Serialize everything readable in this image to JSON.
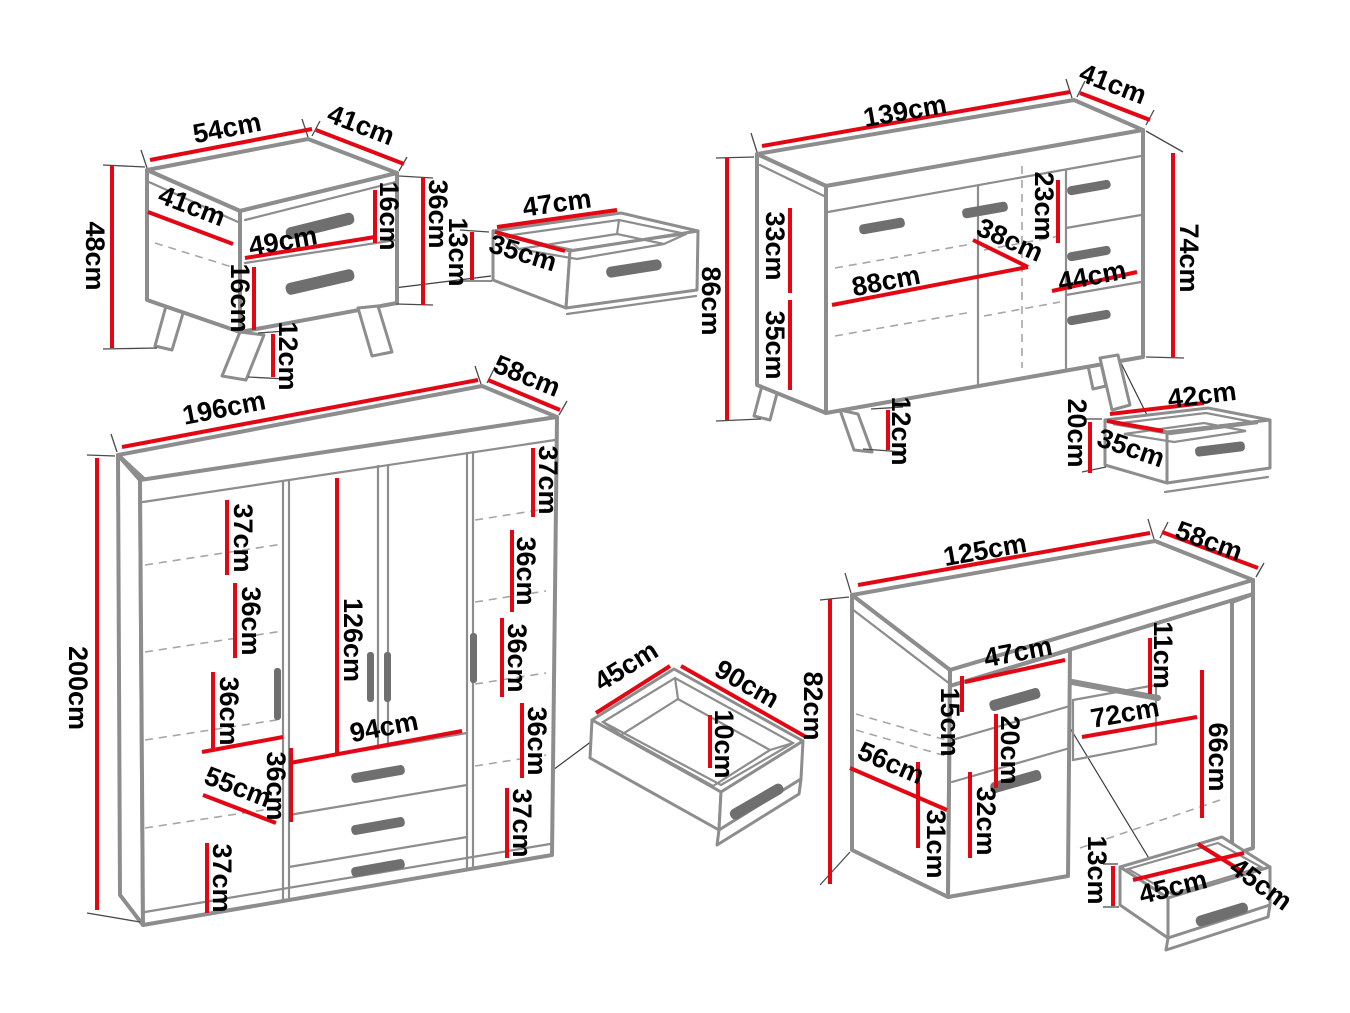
{
  "title": "Bedroom furniture set dimension diagram",
  "unit": "cm",
  "colors": {
    "dimension_line": "#e30613",
    "furniture_outline": "#8d8d8d",
    "label_text": "#000000",
    "handle": "#6f6f6f",
    "background": "#ffffff"
  },
  "furniture": {
    "nightstand": {
      "label": "nightstand",
      "dims": {
        "top_width": "54cm",
        "top_depth": "41cm",
        "height": "48cm",
        "inner_depth": "41cm",
        "drawer_width": "49cm",
        "upper_drawer_height": "16cm",
        "lower_drawer_height": "16cm",
        "carcass_height": "36cm",
        "leg_height": "12cm"
      }
    },
    "nightstand_drawer": {
      "label": "nightstand drawer",
      "dims": {
        "width": "47cm",
        "depth": "35cm",
        "height": "13cm"
      }
    },
    "sideboard": {
      "label": "sideboard",
      "dims": {
        "top_width": "139cm",
        "top_depth": "41cm",
        "height": "86cm",
        "upper_shelf_height": "33cm",
        "lower_shelf_height": "35cm",
        "inner_width": "88cm",
        "door_width": "38cm",
        "drawer_height": "23cm",
        "drawer_width": "44cm",
        "side_height": "74cm",
        "leg_height": "12cm"
      }
    },
    "sideboard_drawer": {
      "label": "sideboard drawer",
      "dims": {
        "width": "42cm",
        "depth": "35cm",
        "height": "20cm"
      }
    },
    "wardrobe": {
      "label": "wardrobe",
      "dims": {
        "top_width": "196cm",
        "top_depth": "58cm",
        "height": "200cm",
        "left_shelf_1": "37cm",
        "left_shelf_2": "36cm",
        "left_shelf_3": "36cm",
        "left_depth": "55cm",
        "left_shelf_4": "37cm",
        "door_height": "126cm",
        "drawer_width": "94cm",
        "center_shelf": "36cm",
        "right_shelf_1": "37cm",
        "right_shelf_2": "36cm",
        "right_shelf_3": "36cm",
        "right_shelf_4": "36cm",
        "right_shelf_5": "37cm"
      }
    },
    "wardrobe_drawer": {
      "label": "wardrobe drawer",
      "dims": {
        "depth": "45cm",
        "width": "90cm",
        "height": "10cm"
      }
    },
    "desk": {
      "label": "desk",
      "dims": {
        "top_width": "125cm",
        "top_depth": "58cm",
        "height": "82cm",
        "drawer_width": "47cm",
        "drawer_height": "15cm",
        "shelf_height": "20cm",
        "tray_height": "11cm",
        "niche_width": "72cm",
        "niche_height": "66cm",
        "side_depth": "56cm",
        "bottom_height": "31cm",
        "door_height": "32cm"
      }
    },
    "desk_drawer": {
      "label": "desk drawer",
      "dims": {
        "height": "13cm",
        "width": "45cm",
        "depth": "45cm"
      }
    }
  }
}
